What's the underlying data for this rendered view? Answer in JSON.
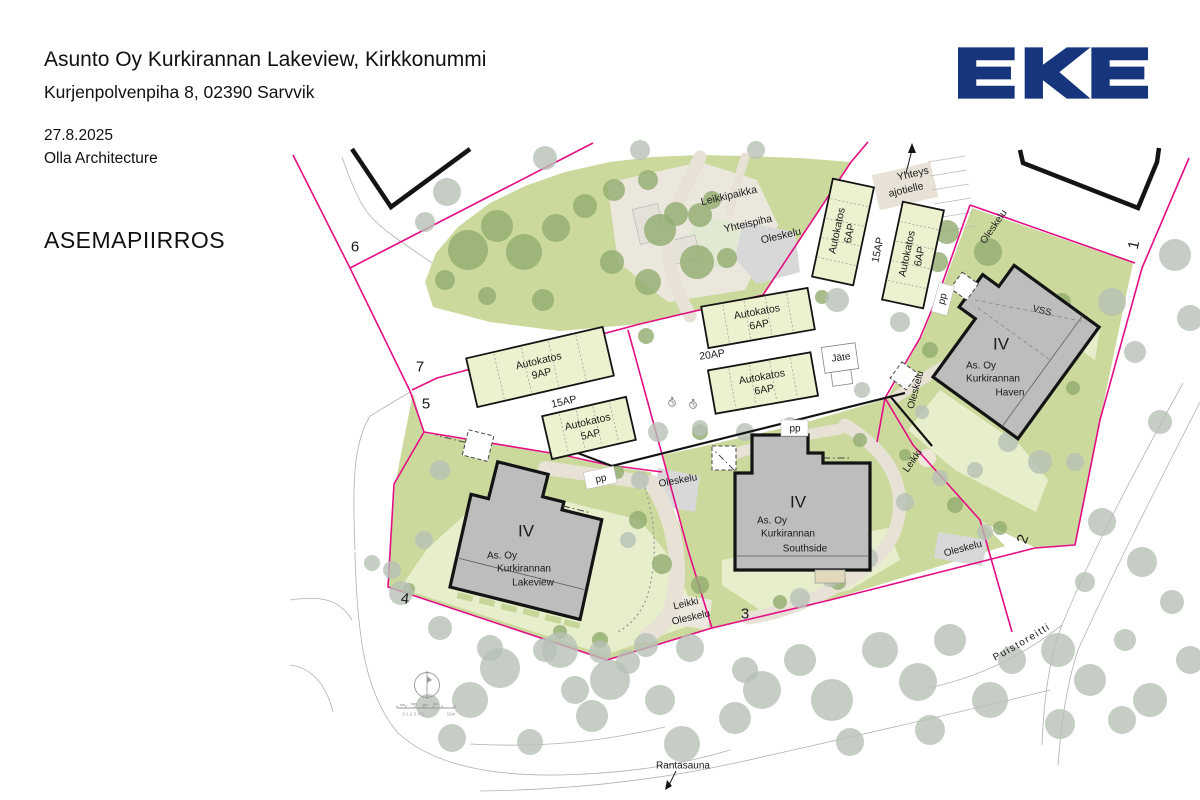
{
  "header": {
    "title": "Asunto Oy Kurkirannan Lakeview, Kirkkonummi",
    "address": "Kurjenpolvenpiha 8, 02390 Sarvvik",
    "date": "27.8.2025",
    "firm": "Olla Architecture",
    "drawing_type": "ASEMAPIIRROS"
  },
  "logo": {
    "text": "EKE"
  },
  "colors": {
    "logo_blue": "#16357c",
    "boundary_magenta": "#e40d85",
    "green_area": "#cbd99c",
    "lawn": "#e6eecb",
    "dark_tree": "#92ad71",
    "gray_tree": "#b6c1b6",
    "path_beige": "#e8e2d6",
    "building_gray": "#bdbdbd",
    "carport_fill": "#eef1cf",
    "pad_gray": "#d8d8d8",
    "ink": "#1a1a1a"
  },
  "site_plan": {
    "buildings": [
      {
        "id": "lakeview",
        "floors": "IV",
        "floors_x": 526,
        "floors_y": 531,
        "name_lines": [
          {
            "text": "As. Oy",
            "x": 502,
            "y": 556
          },
          {
            "text": "Kurkirannan",
            "x": 524,
            "y": 569
          },
          {
            "text": "Lakeview",
            "x": 533,
            "y": 583
          }
        ]
      },
      {
        "id": "southside",
        "floors": "IV",
        "floors_x": 798,
        "floors_y": 502,
        "name_lines": [
          {
            "text": "As. Oy",
            "x": 772,
            "y": 521
          },
          {
            "text": "Kurkirannan",
            "x": 788,
            "y": 534
          },
          {
            "text": "Southside",
            "x": 805,
            "y": 549
          }
        ]
      },
      {
        "id": "haven",
        "floors": "IV",
        "floors_x": 1001,
        "floors_y": 344,
        "name_lines": [
          {
            "text": "As. Oy",
            "x": 981,
            "y": 366
          },
          {
            "text": "Kurkirannan",
            "x": 993,
            "y": 379
          },
          {
            "text": "Haven",
            "x": 1010,
            "y": 393
          }
        ]
      }
    ],
    "carports": [
      {
        "line1": "Autokatos",
        "line2": "9AP",
        "cx": 540,
        "cy": 367,
        "w": 140,
        "h": 50,
        "rot": -13
      },
      {
        "line1": "Autokatos",
        "line2": "5AP",
        "cx": 589,
        "cy": 428,
        "w": 86,
        "h": 44,
        "rot": -13
      },
      {
        "line1": "Autokatos",
        "line2": "6AP",
        "cx": 758,
        "cy": 318,
        "w": 108,
        "h": 42,
        "rot": -10
      },
      {
        "line1": "Autokatos",
        "line2": "6AP",
        "cx": 763,
        "cy": 383,
        "w": 104,
        "h": 44,
        "rot": -10
      },
      {
        "line1": "Autokatos",
        "line2": "6AP",
        "cx": 843,
        "cy": 232,
        "w": 100,
        "h": 42,
        "rot": -78
      },
      {
        "line1": "Autokatos",
        "line2": "6AP",
        "cx": 913,
        "cy": 255,
        "w": 100,
        "h": 42,
        "rot": -78
      }
    ],
    "plot_numbers": [
      {
        "text": "1",
        "x": 1134,
        "y": 245,
        "rot": -78
      },
      {
        "text": "2",
        "x": 1023,
        "y": 539,
        "rot": -70
      },
      {
        "text": "3",
        "x": 745,
        "y": 614,
        "rot": 0
      },
      {
        "text": "4",
        "x": 405,
        "y": 599,
        "rot": 8
      },
      {
        "text": "5",
        "x": 426,
        "y": 404,
        "rot": 0
      },
      {
        "text": "6",
        "x": 355,
        "y": 247,
        "rot": 0
      },
      {
        "text": "7",
        "x": 420,
        "y": 367,
        "rot": 0
      }
    ],
    "area_labels": [
      {
        "text": "Leikkipaikka",
        "x": 729,
        "y": 196,
        "rot": -13,
        "size": 10.5
      },
      {
        "text": "Yhteispiha",
        "x": 748,
        "y": 224,
        "rot": -13,
        "size": 10.5
      },
      {
        "text": "Oleskelu",
        "x": 781,
        "y": 236,
        "rot": -13,
        "size": 10.5
      },
      {
        "text": "Oleskelu",
        "x": 678,
        "y": 481,
        "rot": -10,
        "size": 10
      },
      {
        "text": "Oleskelu",
        "x": 916,
        "y": 390,
        "rot": -75,
        "size": 10
      },
      {
        "text": "Oleskelu",
        "x": 994,
        "y": 227,
        "rot": -55,
        "size": 10
      },
      {
        "text": "Oleskelu",
        "x": 963,
        "y": 549,
        "rot": -15,
        "size": 10
      },
      {
        "text": "Leikki",
        "x": 913,
        "y": 461,
        "rot": -55,
        "size": 10
      },
      {
        "text": "Leikki",
        "x": 686,
        "y": 604,
        "rot": -13,
        "size": 10
      },
      {
        "text": "Oleskelu",
        "x": 691,
        "y": 618,
        "rot": -13,
        "size": 10
      },
      {
        "text": "VSS",
        "x": 1042,
        "y": 311,
        "rot": 14,
        "size": 9.5
      },
      {
        "text": "Yhteys",
        "x": 913,
        "y": 174,
        "rot": -13,
        "size": 10.5
      },
      {
        "text": "ajotielle",
        "x": 906,
        "y": 190,
        "rot": -13,
        "size": 10.5
      },
      {
        "text": "Jäte",
        "x": 841,
        "y": 358,
        "rot": -8,
        "size": 10
      },
      {
        "text": "pp",
        "x": 601,
        "y": 479,
        "rot": -12,
        "size": 10
      },
      {
        "text": "pp",
        "x": 795,
        "y": 429,
        "rot": 0,
        "size": 10
      },
      {
        "text": "pp",
        "x": 943,
        "y": 299,
        "rot": -75,
        "size": 10
      },
      {
        "text": "Rantasauna",
        "x": 683,
        "y": 766,
        "rot": 0,
        "size": 10
      },
      {
        "text": "15AP",
        "x": 564,
        "y": 402,
        "rot": -13,
        "size": 10.5
      },
      {
        "text": "20AP",
        "x": 712,
        "y": 355,
        "rot": -8,
        "size": 10.5
      },
      {
        "text": "15AP",
        "x": 878,
        "y": 250,
        "rot": -78,
        "size": 10.5
      }
    ],
    "path_labels": [
      {
        "text": "Puistoreitti",
        "path": "puistopath",
        "size": 10,
        "letter_spacing": 1.5
      }
    ],
    "scale_bar": {
      "numbers": "0 1 2 3 4 5",
      "unit": "10m"
    }
  }
}
